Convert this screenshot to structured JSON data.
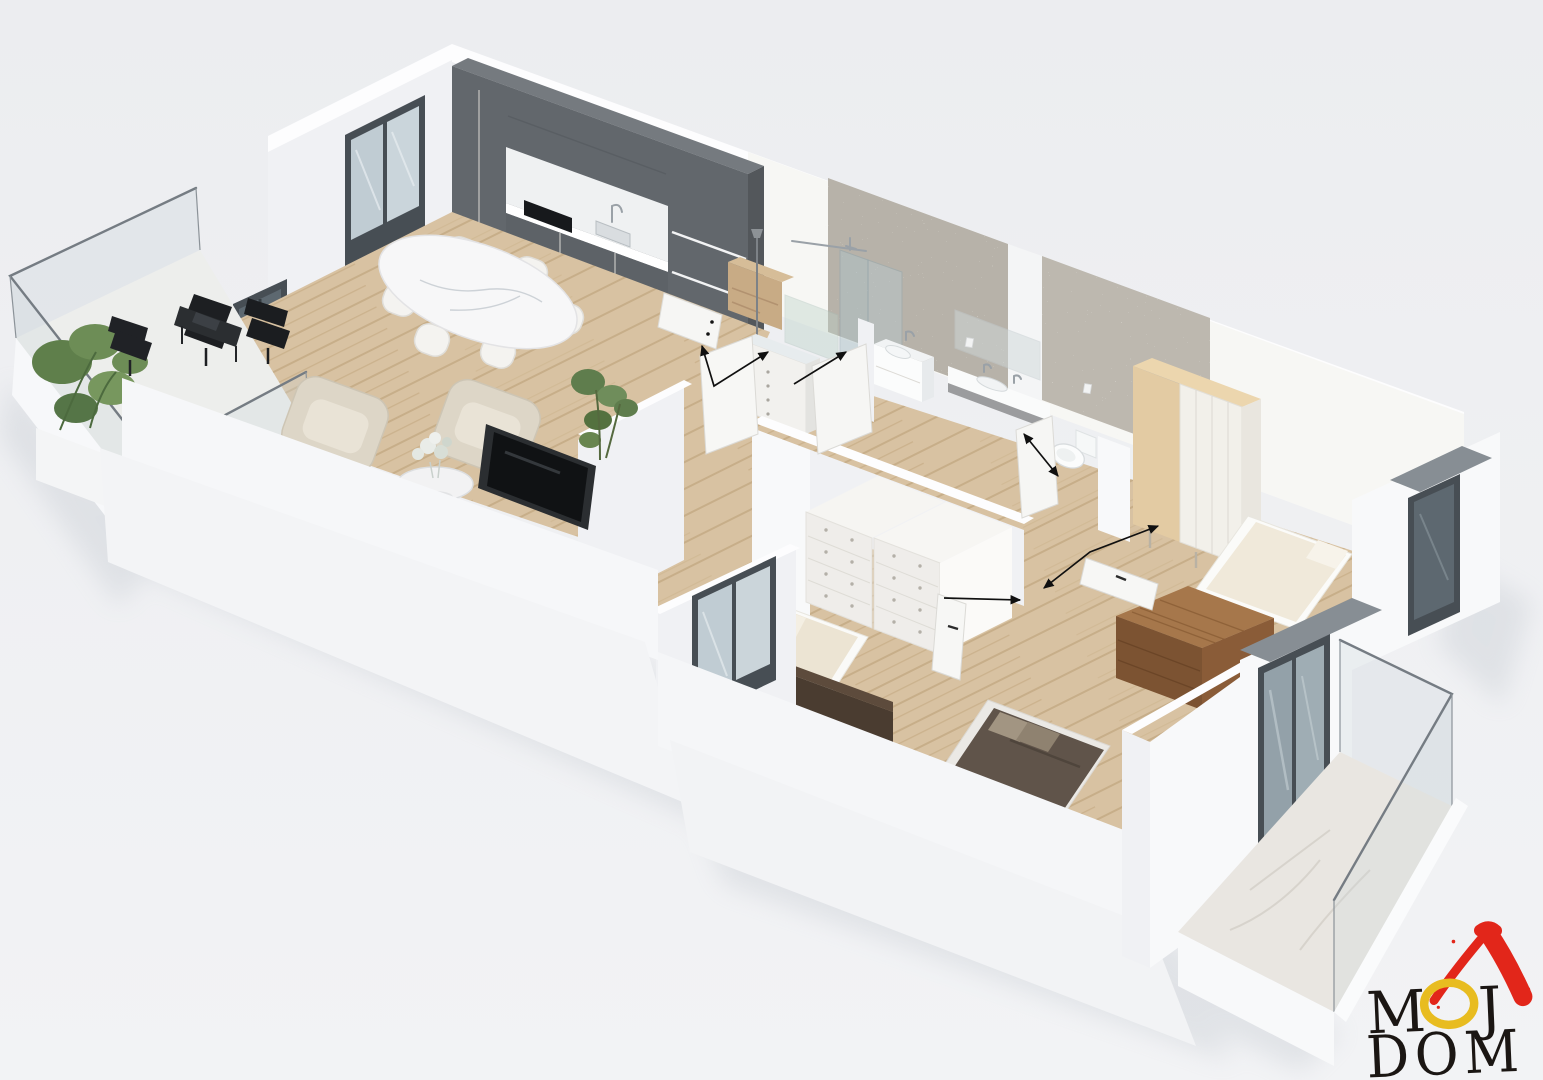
{
  "scene": {
    "type": "isometric-3d-floor-plan-render",
    "background_top": "#ecedf0",
    "background_bottom": "#f2f3f5"
  },
  "logo": {
    "word1": "MOJ",
    "word1_letters": [
      "M",
      "O",
      "J"
    ],
    "word2": "DOM",
    "letter_color": "#1b1613",
    "o_color": "#e8bc20",
    "roof_color": "#e2261a"
  },
  "palette": {
    "kitchen_cabinets": "#62676c",
    "wood_floor": "#d8c2a2",
    "textured_wall": "#b7b2a9",
    "walnut_furniture": "#7c5332",
    "upholstery": "#ddd6c7",
    "dark_bedding": "#60544a",
    "window_frame": "#474e54",
    "lintel_gray": "#878e94"
  }
}
